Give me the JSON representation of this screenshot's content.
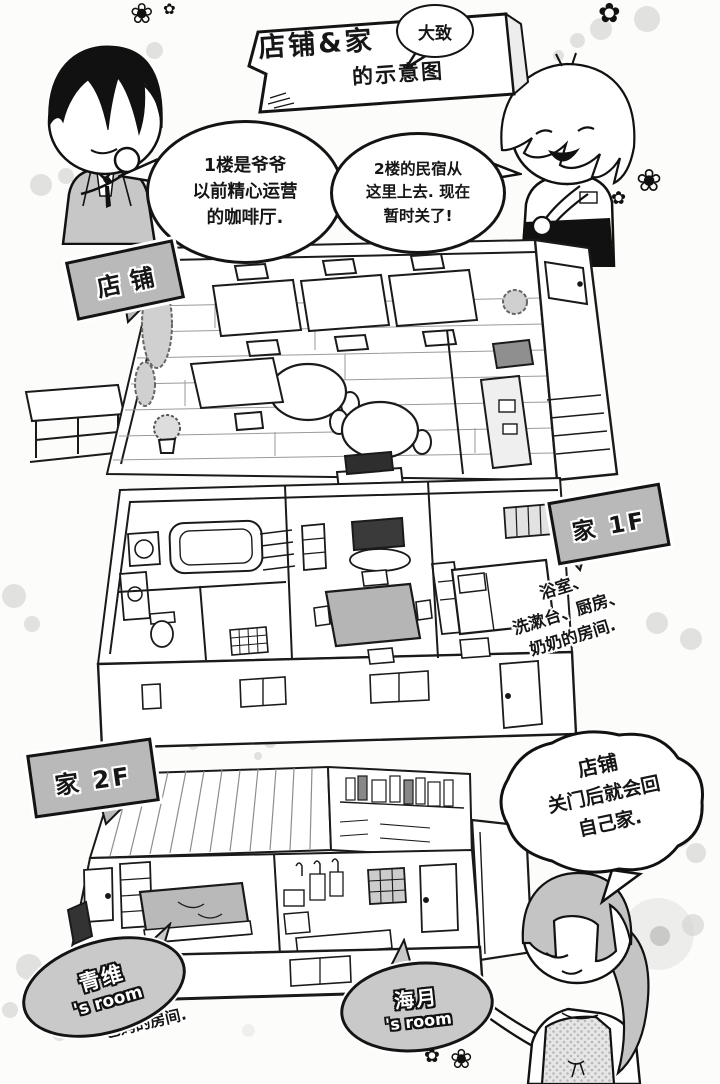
{
  "page": {
    "banner": {
      "title": "店铺&家",
      "badge": "大致",
      "subtitle": "的示意图"
    },
    "speech": {
      "cafe_note": [
        "1楼是爷爷",
        "以前精心运营",
        "的咖啡厅."
      ],
      "guesthouse_note": [
        "2楼的民宿从",
        "这里上去. 现在",
        "暂时关了!"
      ],
      "closing_note": [
        "店铺",
        "关门后就会回",
        "自己家."
      ]
    },
    "labels": {
      "shop": "店铺",
      "home_1f": "家 1F",
      "home_2f": "家 2F"
    },
    "notes": {
      "home_1f_rooms": [
        "浴室、",
        "洗漱台、厨房、",
        "奶奶的房间."
      ],
      "parents_room": [
        "原本是",
        "爸妈的房间."
      ]
    },
    "rooms": {
      "qingwei": {
        "name": "青维",
        "suffix": "'s room"
      },
      "haiyue": {
        "name": "海月",
        "suffix": "'s room"
      }
    },
    "icons": {
      "flower_filled": "✿",
      "flower_outline": "❀"
    }
  }
}
